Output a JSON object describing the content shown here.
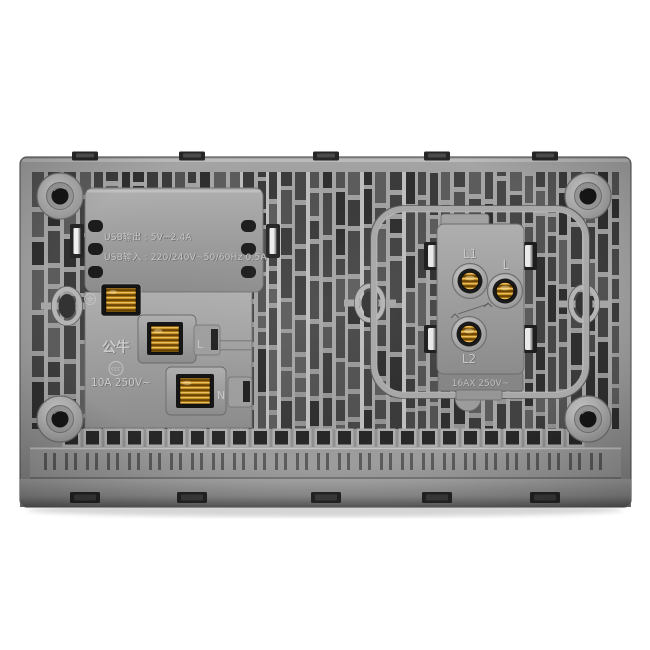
{
  "photo": {
    "subject": "rear view of dual-gang wall plate with USB socket module and switch module",
    "background_color": "#ffffff"
  },
  "colors": {
    "plate_gray": "#9a9a9a",
    "rib_light": "#a7a7a7",
    "recess_dark": "#3f3f3f",
    "slot_black": "#1c1c1c",
    "brass": "#c8860e",
    "spring_clip_white": "#ececec"
  },
  "usb_module": {
    "output_spec": "USB输出 : 5V⎓2.4A",
    "input_spec": "USB输入 : 220/240V~50/60Hz 0.5A"
  },
  "socket_module": {
    "brand": "公牛",
    "certification": "CCC",
    "rating": "10A 250V~",
    "terminal_live": "L",
    "terminal_neutral": "N"
  },
  "switch_module": {
    "terminal_l1": "L1",
    "terminal_l": "L",
    "terminal_l2": "L2",
    "rating": "16AX 250V~"
  },
  "icons": {
    "earth_symbol": "⏚"
  }
}
